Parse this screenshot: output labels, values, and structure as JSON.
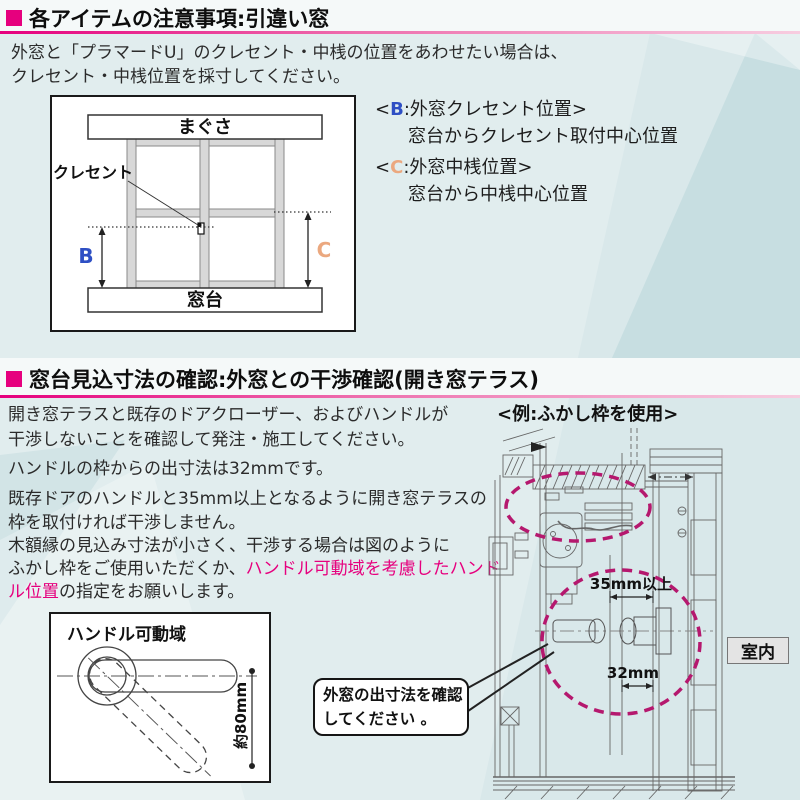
{
  "colors": {
    "accent": "#e6007e",
    "dim_b": "#2e4fc4",
    "dim_c": "#eba87f"
  },
  "section1": {
    "title": "各アイテムの注意事項:引違い窓",
    "body_lines": [
      "外窓と「プラマードU」のクレセント・中桟の位置をあわせたい場合は、",
      "クレセント・中桟位置を採寸してください。"
    ],
    "diagram": {
      "lintel": "まぐさ",
      "sill": "窓台",
      "crescent": "クレセント",
      "b": "B",
      "c": "C"
    },
    "legend": {
      "b_open": "<",
      "b_letter": "B",
      "b_rest": ":外窓クレセント位置>",
      "b_desc": "窓台からクレセント取付中心位置",
      "c_open": "<",
      "c_letter": "C",
      "c_rest": ":外窓中桟位置>",
      "c_desc": "窓台から中桟中心位置"
    }
  },
  "section2": {
    "title": "窓台見込寸法の確認:外窓との干渉確認(開き窓テラス)",
    "p1_l1": "開き窓テラスと既存のドアクローザー、およびハンドルが",
    "p1_l2": "干渉しないことを確認して発注・施工してください。",
    "p2": "ハンドルの枠からの出寸法は32mmです。",
    "p3_l1": "既存ドアのハンドルと35mm以上となるように開き窓テラスの",
    "p3_l2": "枠を取付ければ干渉しません。",
    "p4_l1": "木額縁の見込み寸法が小さく、干渉する場合は図のように",
    "p4_l2_pre": "ふかし枠をご使用いただくか、",
    "p4_l2_hl": "ハンドル可動域を考慮したハンド",
    "p4_l3_hl": "ル位置",
    "p4_l3_post": "の指定をお願いします。",
    "example_label": "<例:ふかし枠を使用>",
    "drawing": {
      "dim_min": "35mm以上",
      "dim_out": "32mm",
      "room": "室内"
    },
    "handle_diagram": {
      "title": "ハンドル可動域",
      "dim": "約80mm"
    },
    "callout": {
      "line1": "外窓の出寸法を確認",
      "line2": "してください 。"
    }
  }
}
